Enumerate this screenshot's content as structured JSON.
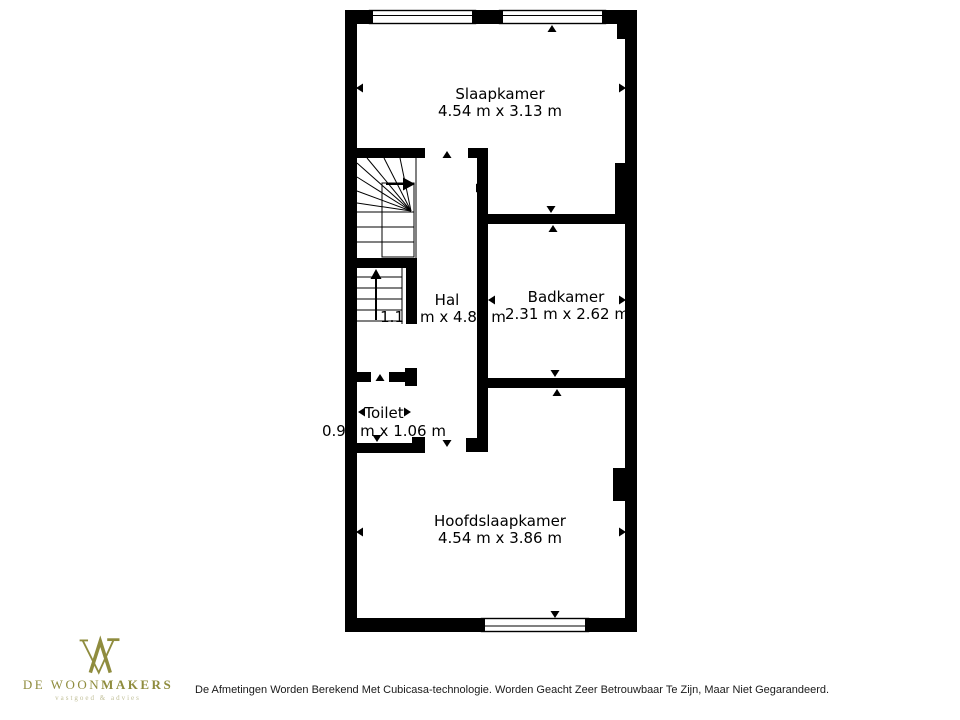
{
  "floorplan": {
    "wall_color": "#000000",
    "floor_color": "#ffffff",
    "rooms": {
      "slaapkamer": {
        "name": "Slaapkamer",
        "dims": "4.54 m x 3.13 m"
      },
      "badkamer": {
        "name": "Badkamer",
        "dims": "2.31 m x 2.62 m"
      },
      "hal": {
        "name": "Hal",
        "dims_left": "1.1",
        "dims_right": "m x 4.80 m"
      },
      "toilet": {
        "name": "Toilet",
        "dims": "0.99 m x 1.06 m"
      },
      "hoofdslaapkamer": {
        "name": "Hoofdslaapkamer",
        "dims": "4.54 m x 3.86 m"
      }
    }
  },
  "branding": {
    "name_regular": "DE WOON",
    "name_bold": "MAKERS",
    "tagline": "vastgoed & advies",
    "logo_color": "#8f8c3e",
    "tagline_color": "#c2c09a"
  },
  "footer": {
    "disclaimer": "De Afmetingen Worden Berekend Met Cubicasa-technologie. Worden Geacht Zeer Betrouwbaar Te Zijn, Maar Niet Gegarandeerd."
  }
}
